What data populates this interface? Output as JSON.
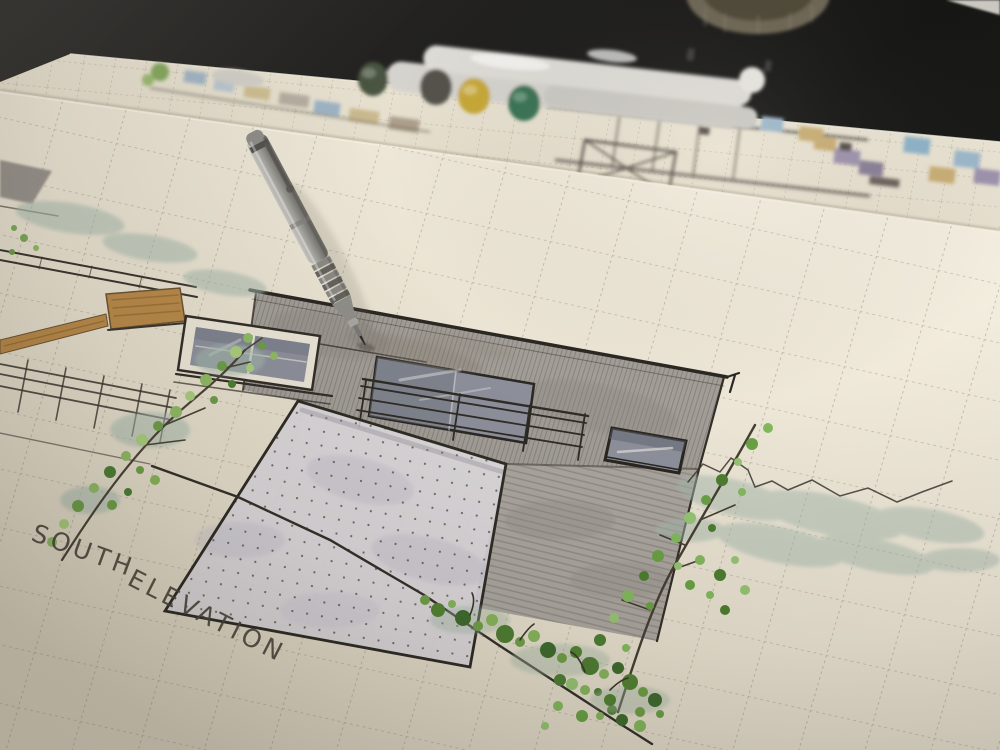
{
  "photo": {
    "annotation": {
      "word1": "SOUTH",
      "word2": "ELEVATION"
    },
    "objects": {
      "pencil": "mechanical-drafting-pencil",
      "markers": "four-capped-art-markers",
      "front_sheet": "south-elevation-sketch-sheet",
      "back_sheet": "floor-plan-sketch-sheet",
      "jar": "round-glass-jar"
    },
    "palette": {
      "desk": "#1c1b19",
      "paper_front": "#eae3d3",
      "paper_back": "#e7e0d0",
      "ink": "#4a443a",
      "grid": "#8f8672",
      "wall_gray": "#a29d97",
      "lower_wall_gray": "#aaa59e",
      "stucco": "#d8d5db",
      "glass": "#8d909b",
      "wood_tan": "#b8894a",
      "leaf_green": "#7fae54",
      "sage_green": "#a4b8ab",
      "cap_olive": "#49553f",
      "cap_charcoal": "#54524c",
      "cap_yellow": "#c7a838",
      "cap_green": "#3a7354",
      "pencil_silver": "#9a9894"
    }
  }
}
